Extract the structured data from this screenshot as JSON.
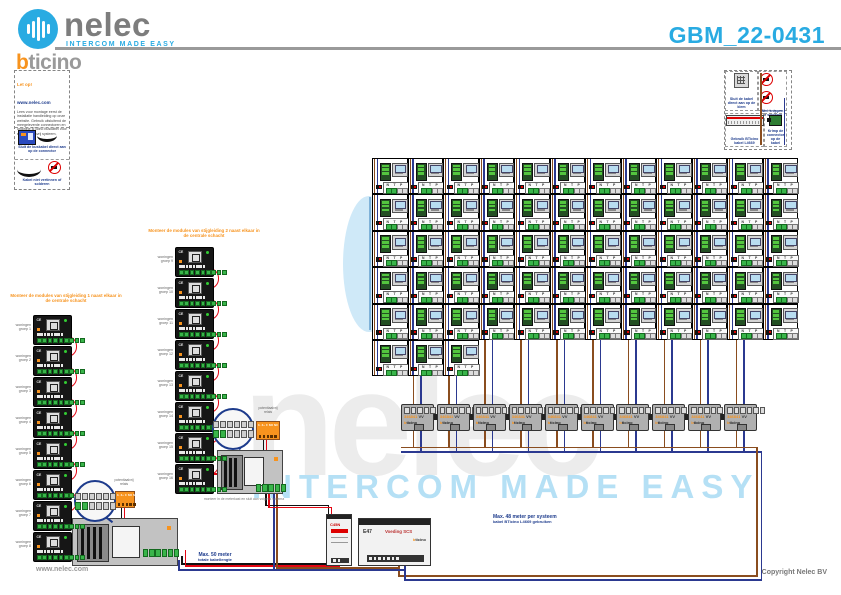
{
  "header": {
    "brand": "nelec",
    "tagline": "INTERCOM MADE EASY",
    "brand2_b": "b",
    "brand2_rest": "ticino",
    "doc_title": "GBM_22-0431"
  },
  "footer": {
    "copyright": "Copyright Nelec BV",
    "website": "www.nelec.com"
  },
  "colors": {
    "accent_blue": "#29abe2",
    "brand_orange": "#f7931e",
    "wire_blue": "#2b3990",
    "wire_brown": "#8a4d1f",
    "wire_red": "#e30613",
    "wire_black": "#111111",
    "wire_lightblue": "#7fb2d9",
    "annotation_blue": "#1d3b8c",
    "watermark_gray": "#ececec",
    "watermark_blue": "#b5e0f5"
  },
  "note_box": {
    "heading": "Let op!",
    "link": "www.nelec.com",
    "body": "Lees voor montage eerst de installatie handleiding op onze website. Gebruik uitsluitend de meegeleverde connectoren en originele BTicino buskabel voor een storingsvrij systeem.",
    "captions": [
      "Sluit de buskabel direct aan op de connector",
      "Kabel niet vertinnen of solderen"
    ]
  },
  "legend_box": {
    "cells": [
      "Sluit de kabel direct aan op de klem",
      "Niet knippen of solderen",
      "Gebruik BTicino kabel L4669",
      "Krimp de connector op de kabel"
    ]
  },
  "apartment_grid": {
    "columns": 12,
    "units_per_row": [
      12,
      12,
      12,
      12,
      12,
      3
    ],
    "total_units": 63,
    "unit_terminals": [
      "N",
      "T",
      "P"
    ]
  },
  "distributor_row": {
    "count": 10,
    "label": "346841",
    "suffix": "VV",
    "brand_b": "b",
    "brand_rest": "ticino"
  },
  "chains": [
    {
      "title": "Monteer de modules van stijgleiding 1 naast elkaar in de centrale schacht",
      "modules": [
        {
          "label": "woningen|groep 1"
        },
        {
          "label": "woningen|groep 2"
        },
        {
          "label": "woningen|groep 3"
        },
        {
          "label": "woningen|groep 4"
        },
        {
          "label": "woningen|groep 5"
        },
        {
          "label": "woningen|groep 6"
        },
        {
          "label": "woningen|groep 7"
        },
        {
          "label": "woningen|groep 8"
        }
      ]
    },
    {
      "title": "Monteer de modules van stijgleiding 2 naast elkaar in de centrale schacht",
      "modules": [
        {
          "label": "woningen|groep 9"
        },
        {
          "label": "woningen|groep 10"
        },
        {
          "label": "woningen|groep 11"
        },
        {
          "label": "woningen|groep 12"
        },
        {
          "label": "woningen|groep 13"
        },
        {
          "label": "woningen|groep 14"
        },
        {
          "label": "woningen|groep 15"
        },
        {
          "label": "woningen|groep 16"
        }
      ]
    }
  ],
  "relays": [
    {
      "label": "potentiaalvrij|relais",
      "terminals": "3- 3+ C NO NC"
    },
    {
      "label": "potentiaalvrij|relais",
      "terminals": "3- 3+ C NO NC"
    }
  ],
  "din_modules": [
    {
      "label": "C45N"
    },
    {
      "label": "E47",
      "name": "Voeding SCS",
      "brand_b": "b",
      "brand_rest": "ticino"
    }
  ],
  "cabinets": [
    {
      "note": ""
    },
    {
      "note": "monteer in de meterkast en sluit aan volgens schema"
    }
  ],
  "annotations": [
    {
      "line1": "Max. 50 meter",
      "line2": "totale kabellengte"
    },
    {
      "line1": "Max. 48 meter per systeem",
      "line2": "kabel BTicino L4669 gebruiken"
    }
  ],
  "watermark": {
    "text": "nelec",
    "tagline": "INTERCOM MADE EASY"
  }
}
